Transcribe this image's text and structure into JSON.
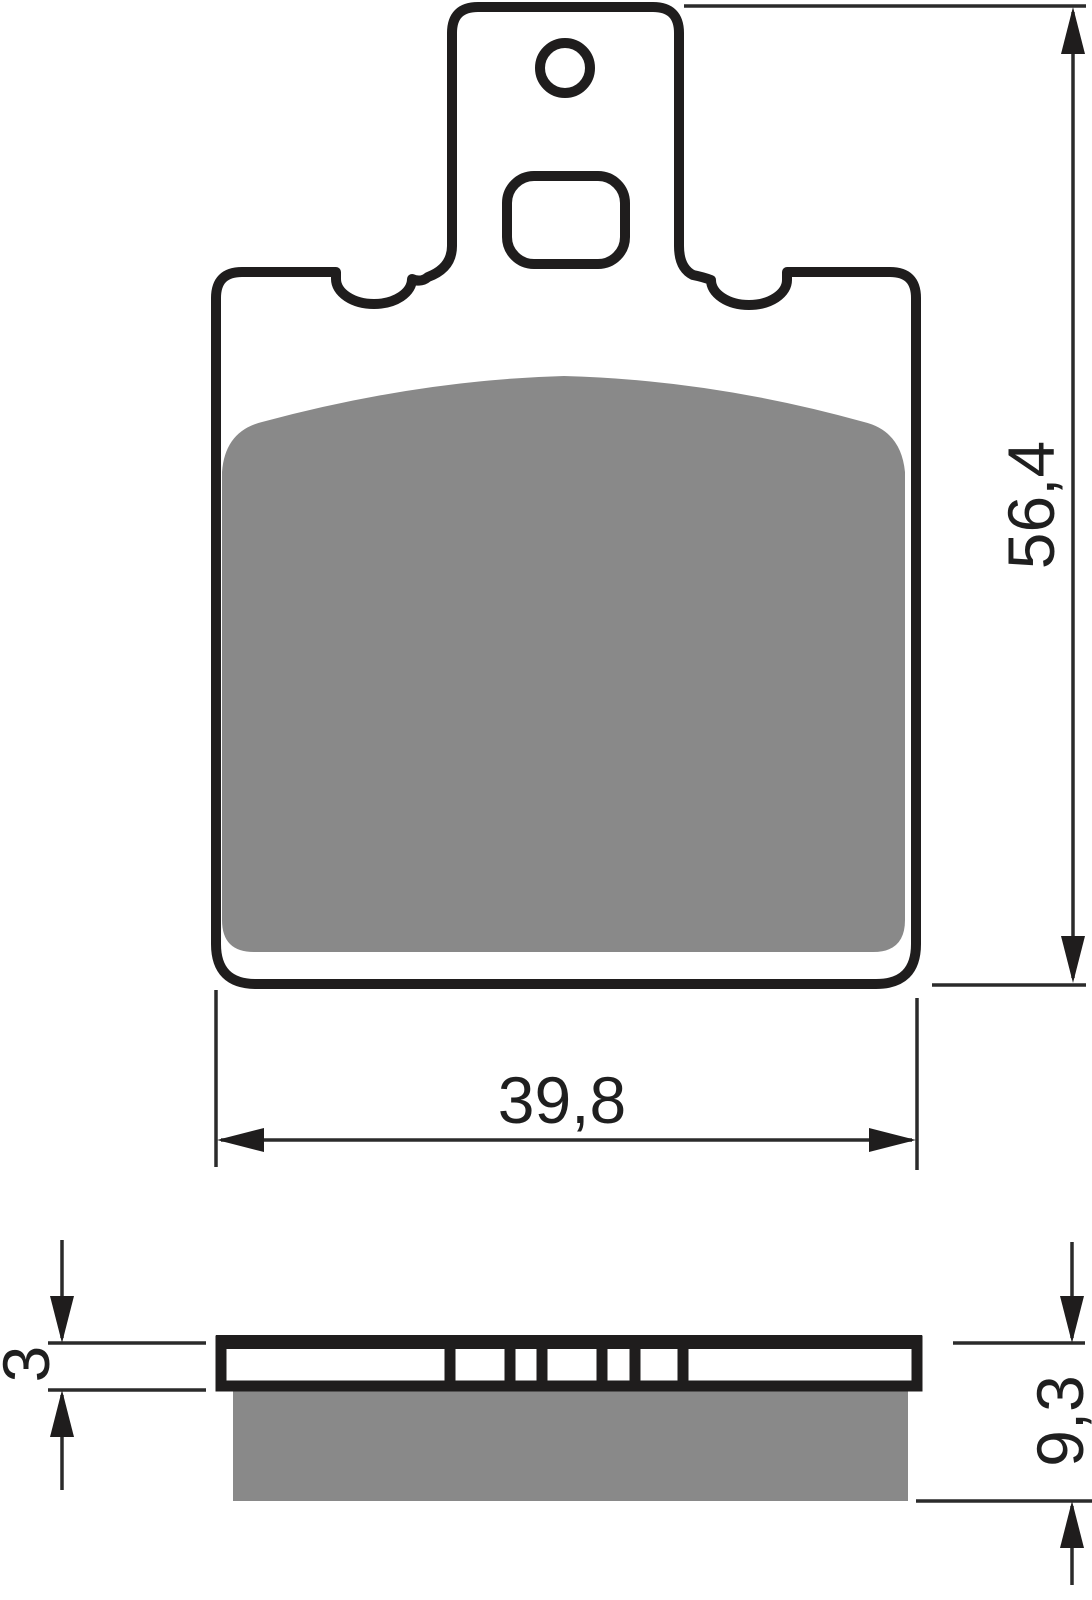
{
  "drawing": {
    "title": "brake-pad-technical-drawing",
    "views": {
      "front": "pad with mounting tab, round pin hole, rounded slot hole, friction material area",
      "side": "backing plate cross-section with segment slots and friction material block"
    }
  },
  "dimensions": {
    "height": {
      "value": "56,4"
    },
    "width": {
      "value": "39,8"
    },
    "plate_thickness": {
      "value": "3"
    },
    "total_thickness": {
      "value": "9,3"
    }
  },
  "colors": {
    "outline": "#1f1d1d",
    "friction_material": "#898989",
    "dimension_lines": "#2b2b2b",
    "background": "#ffffff"
  }
}
